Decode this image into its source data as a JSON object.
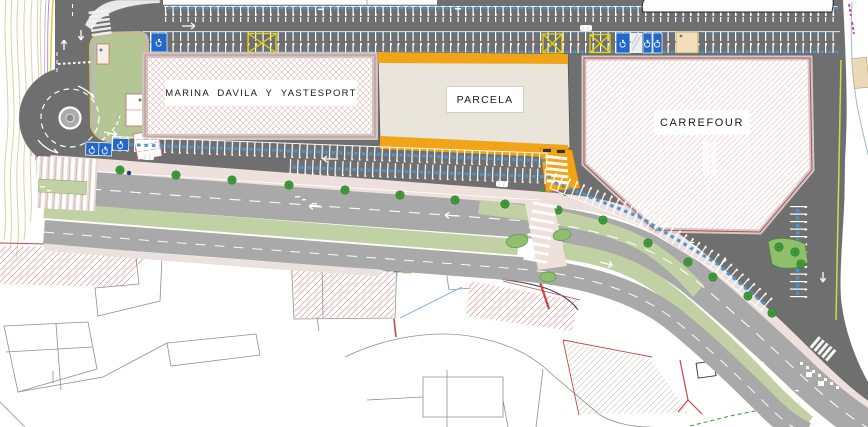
{
  "plan": {
    "labels": {
      "building_marina": "MARINA DAVILA Y YASTESPORT",
      "building_parcela": "PARCELA",
      "building_carrefour": "CARREFOUR"
    },
    "colors": {
      "asphalt": "#6f6f6f",
      "road_light": "#a9a9a9",
      "sidewalk_pink": "#eee0dc",
      "median_green": "#c2d1a3",
      "island_green": "#8fbf6a",
      "park_green": "#b3c693",
      "parking_blue": "#4596d2",
      "handicap_blue": "#2268cc",
      "no_parking_yellow": "#e9d400",
      "parcela_orange": "#f2a418",
      "building_beige": "#e9e5da",
      "hatch_pink": "#e0b2b2",
      "demolition_red": "#cc4040",
      "cadastral_gray": "#8f8f8f",
      "tree_green": "#3f9b3b",
      "contour_tan": "#d8d2a8",
      "edge_yellow": "#d6ca2a"
    }
  }
}
